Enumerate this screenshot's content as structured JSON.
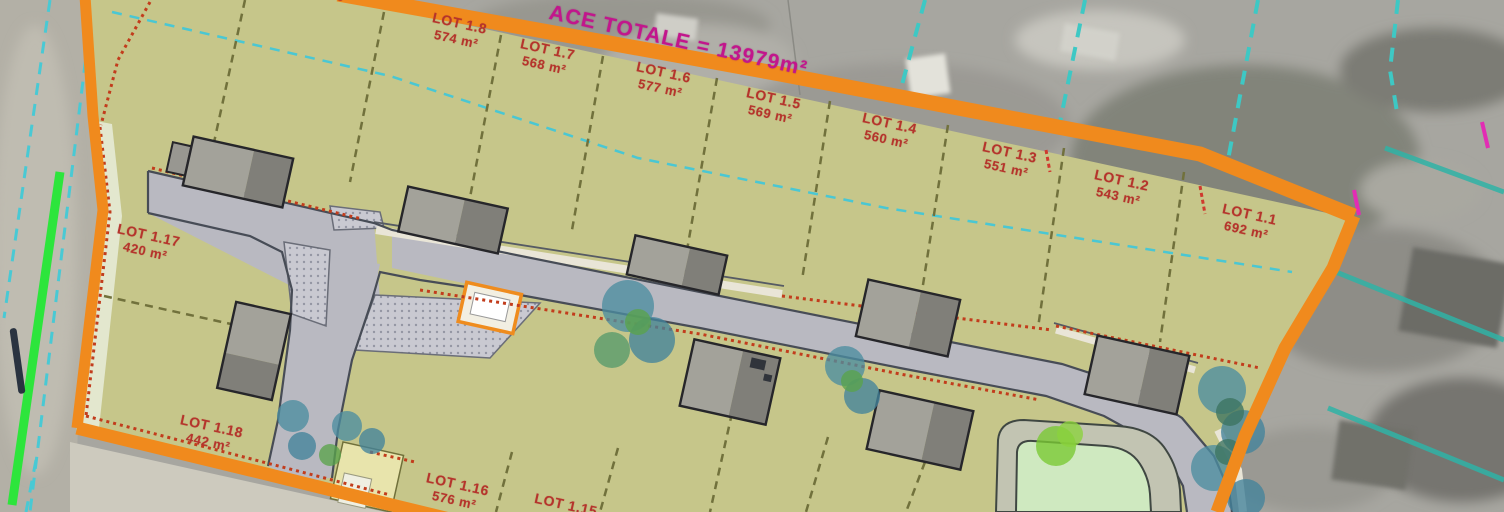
{
  "document": {
    "kind": "subdivision-site-plan-over-aerial-photo",
    "language": "fr"
  },
  "title": {
    "text": "ACE TOTALE = 13979m²",
    "angle_deg": 12.5
  },
  "lots": [
    {
      "id": "LOT 1.1",
      "area": "692 m²",
      "x": 1248,
      "y": 222,
      "angle": 12.5
    },
    {
      "id": "LOT 1.2",
      "area": "543 m²",
      "x": 1120,
      "y": 188,
      "angle": 12.5
    },
    {
      "id": "LOT 1.3",
      "area": "551 m²",
      "x": 1008,
      "y": 160,
      "angle": 12.5
    },
    {
      "id": "LOT 1.4",
      "area": "560 m²",
      "x": 888,
      "y": 131,
      "angle": 12.5
    },
    {
      "id": "LOT 1.5",
      "area": "569 m²",
      "x": 772,
      "y": 106,
      "angle": 12.5
    },
    {
      "id": "LOT 1.6",
      "area": "577 m²",
      "x": 662,
      "y": 80,
      "angle": 12.5
    },
    {
      "id": "LOT 1.7",
      "area": "568 m²",
      "x": 546,
      "y": 57,
      "angle": 12.5
    },
    {
      "id": "LOT 1.8",
      "area": "574 m²",
      "x": 458,
      "y": 31,
      "angle": 12.5
    },
    {
      "id": "LOT 1.9",
      "area": "",
      "x": 318,
      "y": -9,
      "angle": 12.5
    },
    {
      "id": "LOT 1.15",
      "area": "",
      "x": 566,
      "y": 505,
      "angle": 12.5
    },
    {
      "id": "LOT 1.16",
      "area": "576 m²",
      "x": 456,
      "y": 492,
      "angle": 12.5
    },
    {
      "id": "LOT 1.17",
      "area": "420 m²",
      "x": 147,
      "y": 243,
      "angle": 12.5
    },
    {
      "id": "LOT 1.18",
      "area": "442 m²",
      "x": 210,
      "y": 434,
      "angle": 12.5
    }
  ],
  "colors": {
    "site_boundary_orange": "#f08a1d",
    "lot_fill_olive": "#c6c68a",
    "road_gray": "#b9b9c1",
    "road_edge": "#474c56",
    "lot_label_red": "#b5342c",
    "title_magenta": "#c2168c",
    "cadastre_cyan": "#3cc6da",
    "cadastre_teal": "#2fb3a6",
    "utility_green": "#2de53c",
    "hedge_red": "#c23c1c",
    "basin_green": "#cfe9c0",
    "tree_teal": "#4b8da0",
    "aerial_gray": "#a7a6a0"
  }
}
